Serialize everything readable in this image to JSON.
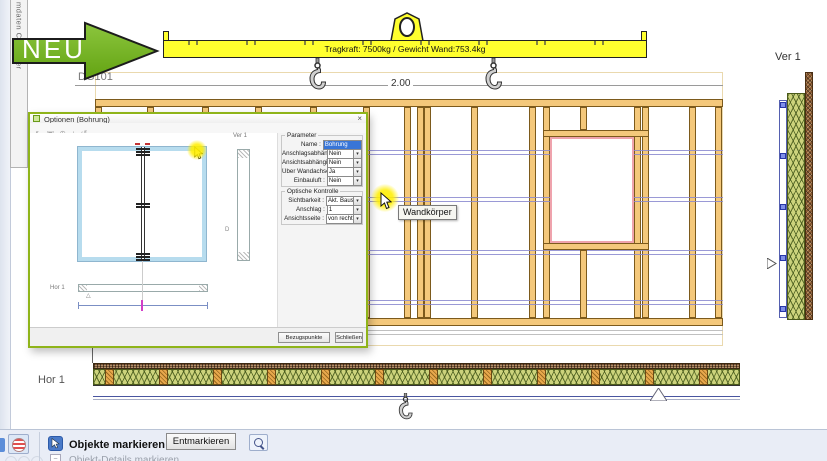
{
  "window": {
    "left_tab_label": "mdaten Container"
  },
  "arrow": {
    "label": "NEU",
    "color": "#76b82a"
  },
  "beam": {
    "label": "Tragkraft: 7500kg / Gewicht Wand:753.4kg",
    "color": "#ffff2e"
  },
  "drawing": {
    "level_label": "DG101",
    "dim_label": "2.00",
    "ver_label": "Ver 1",
    "hor_label": "Hor 1",
    "tooltip": "Wandkörper",
    "studs_x": [
      95,
      147,
      202,
      255,
      310,
      363,
      404,
      417,
      424,
      471,
      529,
      543,
      634,
      642,
      689,
      715
    ],
    "purple_lines_y": [
      150,
      154,
      197,
      201,
      250,
      254,
      300,
      304
    ],
    "ver_markers_y": [
      102,
      153,
      204,
      255,
      306
    ],
    "hor_blocks_x": [
      105,
      159,
      213,
      267,
      321,
      375,
      429,
      483,
      537,
      591,
      645,
      699
    ]
  },
  "dialog": {
    "title": "Optionen (Bohrung)",
    "close_label": "×",
    "toolbar_icons": [
      {
        "name": "select-icon",
        "glyph": "↖"
      },
      {
        "name": "zoom-window-icon",
        "glyph": "▣"
      },
      {
        "name": "zoom-icon",
        "glyph": "⊕"
      },
      {
        "name": "pan-icon",
        "glyph": "+"
      },
      {
        "name": "undo-icon",
        "glyph": "↺"
      }
    ],
    "preview": {
      "ver_label": "Ver 1",
      "hor_label": "Hor 1",
      "d_label": "D",
      "tri_label": "△"
    },
    "groups": [
      {
        "title": "Parameter",
        "rows": [
          {
            "label": "Name :",
            "value": "Bohrung",
            "type": "text"
          },
          {
            "label": "Anschlagsabhängig :",
            "value": "Nein",
            "type": "select"
          },
          {
            "label": "Ansichtsabhängig :",
            "value": "Nein",
            "type": "select"
          },
          {
            "label": "Über Wandachse :",
            "value": "Ja",
            "type": "select"
          },
          {
            "label": "Einbauluft :",
            "value": "Nein",
            "type": "select"
          }
        ]
      },
      {
        "title": "Optische Kontrolle",
        "rows": [
          {
            "label": "Sichtbarkeit :",
            "value": "Akt. Baustein",
            "type": "select"
          },
          {
            "label": "Anschlag :",
            "value": "1",
            "type": "select"
          },
          {
            "label": "Ansichtsseite :",
            "value": "von rechts",
            "type": "select"
          }
        ]
      }
    ],
    "buttons": [
      "Bezugspunkte ändern",
      "Schließen"
    ]
  },
  "statusbar": {
    "primary": "Objekte markieren",
    "secondary": "Objekt-Details markieren",
    "unmark_button": "Entmarkieren",
    "tilde_glyph": "~"
  }
}
